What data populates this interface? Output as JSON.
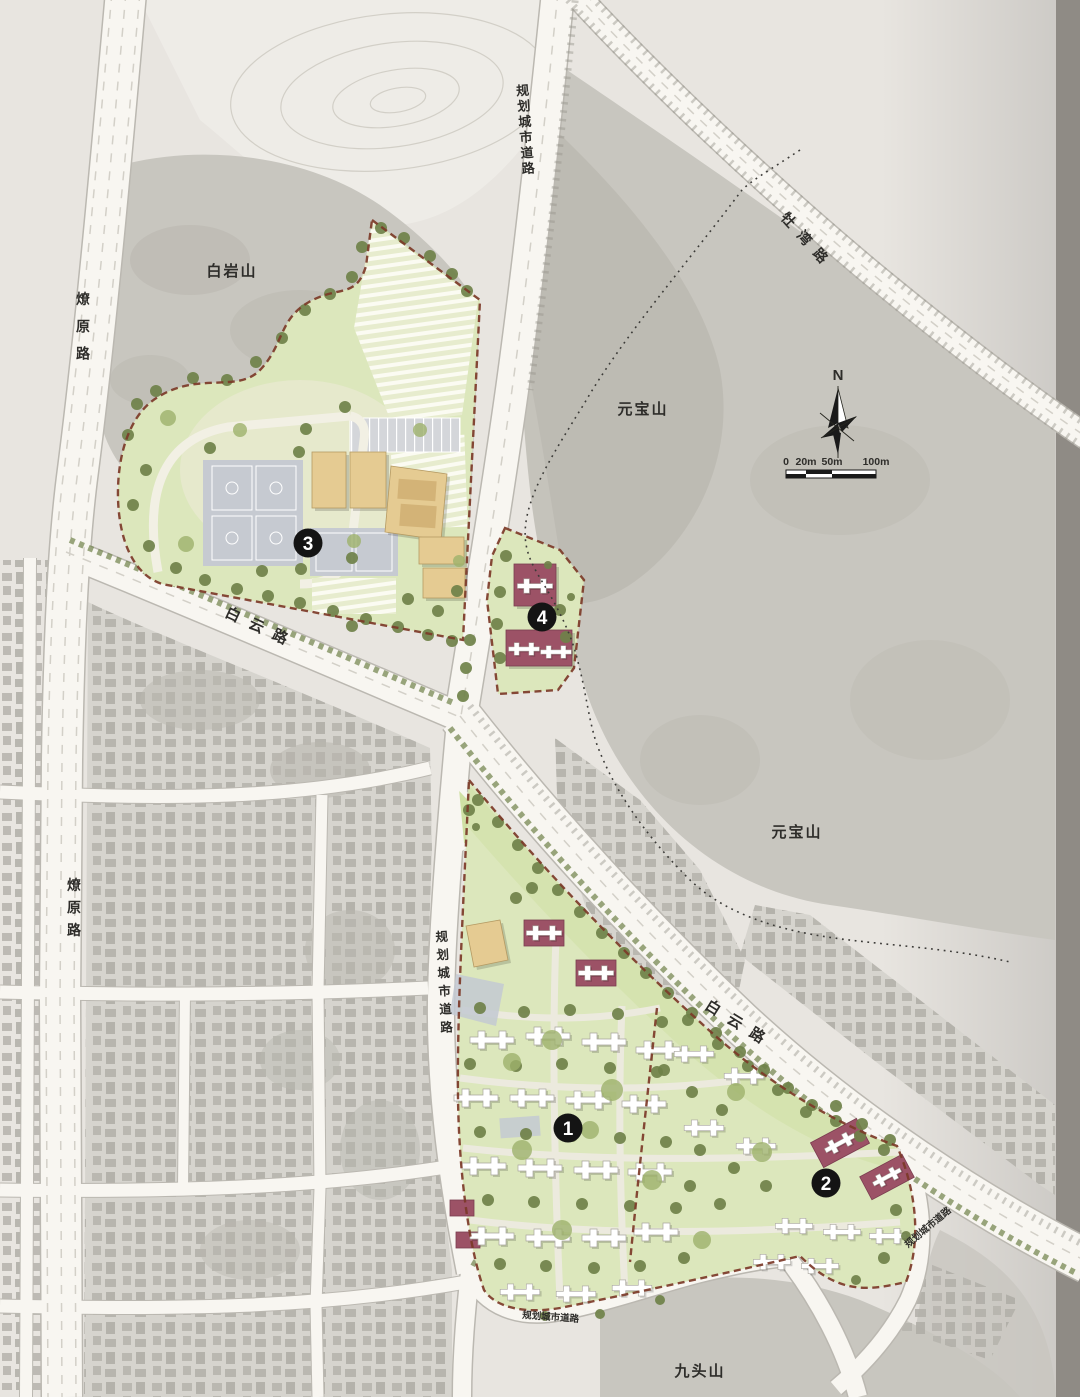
{
  "map": {
    "mountain_labels": [
      {
        "text": "白岩山"
      },
      {
        "text": "元宝山"
      },
      {
        "text": "元宝山"
      },
      {
        "text": "九头山"
      }
    ],
    "road_labels": [
      {
        "text": "燎原路"
      },
      {
        "text": "燎原路"
      },
      {
        "text": "规划城市道路"
      },
      {
        "text": "牡湾路"
      },
      {
        "text": "白云路"
      },
      {
        "text": "白云路"
      },
      {
        "text": "规划城市道路"
      },
      {
        "text": "规划城市道路"
      },
      {
        "text": "规划城市道路"
      }
    ],
    "zone_markers": [
      {
        "number": "1"
      },
      {
        "number": "2"
      },
      {
        "number": "3"
      },
      {
        "number": "4"
      }
    ],
    "compass": {
      "label": "N"
    },
    "scale_bar": {
      "ticks": [
        "0",
        "20m",
        "50m",
        "100m"
      ]
    }
  },
  "colors": {
    "paper": "#e8e5e0",
    "mountain": "#c8c6bf",
    "mountain-dark": "#b9b7af",
    "contour-zone": "#eeece7",
    "road": "#f8f6f1",
    "road-edge": "#bbb8b1",
    "lawn": "#dce7bc",
    "lawn-bright": "#cfe0a4",
    "cream": "#efecdc",
    "tree-dark": "#6f8149",
    "tree-light": "#9db26c",
    "court": "#c6cad1",
    "parking": "#d4d6da",
    "building-tan": "#e5cb92",
    "building-tan-dark": "#d3b377",
    "building-maroon": "#9c5266",
    "building-white": "#ffffff",
    "boundary-red": "#7c3a28",
    "urban": "#b9b7b0",
    "urban-base": "#d6d4ce",
    "ink": "#2e2d2a"
  }
}
